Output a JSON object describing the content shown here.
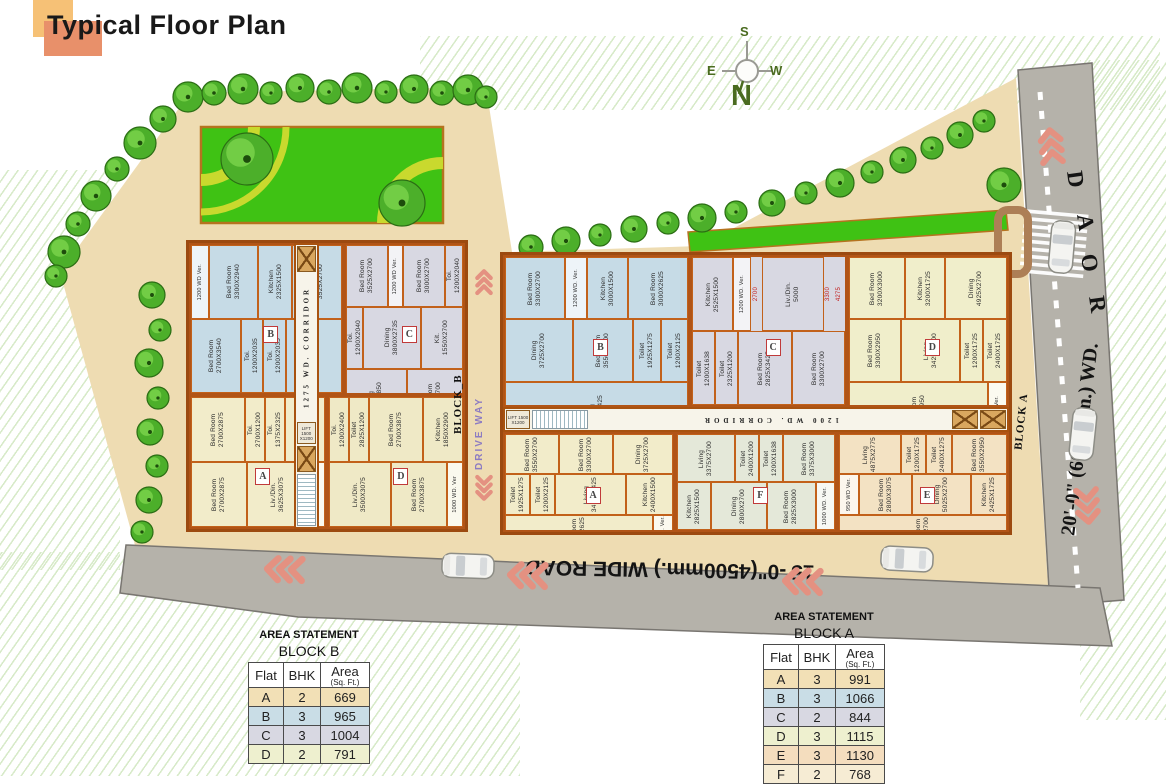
{
  "title": "Typical Floor Plan",
  "compass": {
    "north": "N",
    "south": "S",
    "east": "E",
    "west": "W"
  },
  "site": {
    "driveway_label": "DRIVE WAY",
    "bottom_road_label": "15'-0\"(4500mm.) WIDE ROAD",
    "right_road_width_label": "20'-0\" (6000mm.) WD.",
    "road_letters": [
      "R",
      "O",
      "A",
      "D"
    ]
  },
  "palette": {
    "site_tan": "#eedcb2",
    "road_gray": "#b5b2aa",
    "lawn_green": "#3fc214",
    "wall_orange": "#c2611a",
    "chevron_salmon": "#e49181"
  },
  "blocks": [
    {
      "name": "BLOCK_B",
      "corridor_label": "1275 WD. CORRIDOR",
      "lift_label": "LIFT 1500 X1200",
      "flats": [
        {
          "letter": "B",
          "color": "#c6dbe6",
          "rooms": [
            {
              "kind": "ver",
              "label": "1200 WD Ver.",
              "dim": ""
            },
            {
              "kind": "bed",
              "label": "Bed Room",
              "dim": "3300X2940"
            },
            {
              "kind": "kitchen",
              "label": "Kitchen",
              "dim": "2325X1500"
            },
            {
              "kind": "bed",
              "label": "Bed Room",
              "dim": "3525X2700"
            },
            {
              "kind": "bed",
              "label": "Bed Room",
              "dim": "2700X3540"
            },
            {
              "kind": "toilet",
              "label": "Toi.",
              "dim": "1200X2035"
            },
            {
              "kind": "toilet",
              "label": "Toi.",
              "dim": "1200X2035"
            },
            {
              "kind": "living",
              "label": "Liv./Din.",
              "dim": "2700X5425"
            }
          ]
        },
        {
          "letter": "C",
          "color": "#d8d8e2",
          "rooms": [
            {
              "kind": "bed",
              "label": "Bed Room",
              "dim": "3525X2700"
            },
            {
              "kind": "ver",
              "label": "1200 WD Ver.",
              "dim": ""
            },
            {
              "kind": "bed",
              "label": "Bed Room",
              "dim": "3000X2700"
            },
            {
              "kind": "toilet",
              "label": "Toi.",
              "dim": "1200X2040"
            },
            {
              "kind": "toilet",
              "label": "Toi.",
              "dim": "1200X2040"
            },
            {
              "kind": "dining",
              "label": "Dining",
              "dim": "3800X2735"
            },
            {
              "kind": "kitchen",
              "label": "Kit.",
              "dim": "1550X2700"
            },
            {
              "kind": "living",
              "label": "Living",
              "dim": "2700X4850"
            },
            {
              "kind": "bed",
              "label": "Bed Room",
              "dim": "3000X2700"
            }
          ]
        },
        {
          "letter": "A",
          "color": "#f2ecca",
          "rooms": [
            {
              "kind": "bed",
              "label": "Bed Room",
              "dim": "2700X2875"
            },
            {
              "kind": "toilet",
              "label": "Toi.",
              "dim": "2700X1200"
            },
            {
              "kind": "toilet",
              "label": "Toi.",
              "dim": "1375X2325"
            },
            {
              "kind": "kitchen",
              "label": "Kitchen",
              "dim": "1850X1900"
            },
            {
              "kind": "bed",
              "label": "Bed Room",
              "dim": "2700X2875"
            },
            {
              "kind": "living",
              "label": "Liv./Din.",
              "dim": "3625X3075"
            },
            {
              "kind": "ver",
              "label": "1000 WD. Ver",
              "dim": ""
            }
          ]
        },
        {
          "letter": "D",
          "color": "#efe9c6",
          "rooms": [
            {
              "kind": "toilet",
              "label": "Toi.",
              "dim": "1200X2400"
            },
            {
              "kind": "toilet",
              "label": "Toilet",
              "dim": "2825X1200"
            },
            {
              "kind": "bed",
              "label": "Bed Room",
              "dim": "2700X3875"
            },
            {
              "kind": "kitchen",
              "label": "Kitchen",
              "dim": "1850X2900"
            },
            {
              "kind": "living",
              "label": "Liv./Din.",
              "dim": "3500X3075"
            },
            {
              "kind": "bed",
              "label": "Bed Room",
              "dim": "2700X3875"
            },
            {
              "kind": "ver",
              "label": "1000 WD. Ver",
              "dim": ""
            }
          ]
        }
      ]
    },
    {
      "name": "BLOCK A",
      "corridor_label": "1200 WD. CORRIDOR",
      "lift_label": "LIFT 1500 X1200",
      "flats": [
        {
          "letter": "B",
          "color": "#c6dbe6",
          "rooms": [
            {
              "kind": "bed",
              "label": "Bed Room",
              "dim": "3300X2700"
            },
            {
              "kind": "ver",
              "label": "1200 WD. Ver.",
              "dim": ""
            },
            {
              "kind": "kitchen",
              "label": "Kitchen",
              "dim": "3000X1500"
            },
            {
              "kind": "bed",
              "label": "Bed Room",
              "dim": "3000X2625"
            },
            {
              "kind": "dining",
              "label": "Dining",
              "dim": "3725X2700"
            },
            {
              "kind": "bed",
              "label": "Bed Room",
              "dim": "3550X2700"
            },
            {
              "kind": "toilet",
              "label": "Toilet",
              "dim": "1925X1275"
            },
            {
              "kind": "toilet",
              "label": "Toilet",
              "dim": "1200X2125"
            },
            {
              "kind": "living",
              "label": "Living",
              "dim": "4575X3425"
            }
          ]
        },
        {
          "letter": "C",
          "color": "#d8d8e2",
          "rooms": [
            {
              "kind": "kitchen",
              "label": "Kitchen",
              "dim": "2525X1500"
            },
            {
              "kind": "ver",
              "label": "1200 WD. Ver.",
              "dim": ""
            },
            {
              "kind": "dim",
              "label": "2700",
              "dim": ""
            },
            {
              "kind": "living",
              "label": "Liv./Din.",
              "dim": "5000"
            },
            {
              "kind": "dim",
              "label": "3300",
              "dim": ""
            },
            {
              "kind": "dim",
              "label": "4275",
              "dim": ""
            },
            {
              "kind": "toilet",
              "label": "Toilet",
              "dim": "1200X1638"
            },
            {
              "kind": "toilet",
              "label": "Toilet",
              "dim": "2325X1200"
            },
            {
              "kind": "bed",
              "label": "Bed Room",
              "dim": "2825X3425"
            },
            {
              "kind": "bed",
              "label": "Bed Room",
              "dim": "3300X2700"
            }
          ]
        },
        {
          "letter": "D",
          "color": "#f0eecb",
          "rooms": [
            {
              "kind": "bed",
              "label": "Bed Room",
              "dim": "3200X3000"
            },
            {
              "kind": "kitchen",
              "label": "Kitchen",
              "dim": "3200X1725"
            },
            {
              "kind": "dining",
              "label": "Dining",
              "dim": "4925X2700"
            },
            {
              "kind": "bed",
              "label": "Bed Room",
              "dim": "3300X2950"
            },
            {
              "kind": "living",
              "label": "Living",
              "dim": "3425X4100"
            },
            {
              "kind": "toilet",
              "label": "Toilet",
              "dim": "1200X1725"
            },
            {
              "kind": "toilet",
              "label": "Toilet",
              "dim": "2400X1725"
            },
            {
              "kind": "bed",
              "label": "Bed Room",
              "dim": "3550X2950"
            },
            {
              "kind": "ver",
              "label": "950 WD Ver.",
              "dim": ""
            }
          ]
        },
        {
          "letter": "A",
          "color": "#f2ecca",
          "rooms": [
            {
              "kind": "bed",
              "label": "Bed Room",
              "dim": "3550X2700"
            },
            {
              "kind": "bed",
              "label": "Bed Room",
              "dim": "3300X2700"
            },
            {
              "kind": "dining",
              "label": "Dining",
              "dim": "3725X2700"
            },
            {
              "kind": "toilet",
              "label": "Toilet",
              "dim": "1925X1275"
            },
            {
              "kind": "toilet",
              "label": "Toilet",
              "dim": "1200X2125"
            },
            {
              "kind": "living",
              "label": "Living",
              "dim": "3425X3425"
            },
            {
              "kind": "kitchen",
              "label": "Kitchen",
              "dim": "2400X1500"
            },
            {
              "kind": "bed",
              "label": "Bed Room",
              "dim": "3000X2625"
            },
            {
              "kind": "ver",
              "label": "1200 WD. Ver.",
              "dim": ""
            }
          ]
        },
        {
          "letter": "F",
          "color": "#e4e8d9",
          "rooms": [
            {
              "kind": "living",
              "label": "Living",
              "dim": "3375X2700"
            },
            {
              "kind": "toilet",
              "label": "Toilet",
              "dim": "2400X1200"
            },
            {
              "kind": "toilet",
              "label": "Toilet",
              "dim": "1200X1638"
            },
            {
              "kind": "bed",
              "label": "Bed Room",
              "dim": "3375X3000"
            },
            {
              "kind": "kitchen",
              "label": "Kitchen",
              "dim": "2825X1500"
            },
            {
              "kind": "dining",
              "label": "Dining",
              "dim": "2800X2700"
            },
            {
              "kind": "bed",
              "label": "Bed Room",
              "dim": "2825X3000"
            },
            {
              "kind": "ver",
              "label": "1000 WD. Ver.",
              "dim": ""
            }
          ]
        },
        {
          "letter": "E",
          "color": "#f3e2c3",
          "rooms": [
            {
              "kind": "living",
              "label": "Living",
              "dim": "4875X2775"
            },
            {
              "kind": "toilet",
              "label": "Toilet",
              "dim": "1200X1725"
            },
            {
              "kind": "toilet",
              "label": "Toilet",
              "dim": "2400X1275"
            },
            {
              "kind": "bed",
              "label": "Bed Room",
              "dim": "3550X2950"
            },
            {
              "kind": "ver",
              "label": "950 WD Ver.",
              "dim": ""
            },
            {
              "kind": "bed",
              "label": "Bed Room",
              "dim": "2800X3075"
            },
            {
              "kind": "dining",
              "label": "Dining",
              "dim": "5025X2700"
            },
            {
              "kind": "kitchen",
              "label": "Kitchen",
              "dim": "2425X1725"
            },
            {
              "kind": "bed",
              "label": "Bed Room",
              "dim": "3400X2700"
            }
          ]
        }
      ]
    }
  ],
  "area_tables": [
    {
      "title": "AREA STATEMENT",
      "block": "BLOCK B",
      "headers": {
        "flat": "Flat",
        "bhk": "BHK",
        "area": "Area",
        "area_sub": "(Sq. Ft.)"
      },
      "rows": [
        {
          "flat": "A",
          "bhk": "2",
          "area": "669",
          "color": "#f2e0b6"
        },
        {
          "flat": "B",
          "bhk": "3",
          "area": "965",
          "color": "#c9dde6"
        },
        {
          "flat": "C",
          "bhk": "3",
          "area": "1004",
          "color": "#d8d8e2"
        },
        {
          "flat": "D",
          "bhk": "2",
          "area": "791",
          "color": "#eef0cf"
        }
      ]
    },
    {
      "title": "AREA STATEMENT",
      "block": "BLOCK A",
      "headers": {
        "flat": "Flat",
        "bhk": "BHK",
        "area": "Area",
        "area_sub": "(Sq. Ft.)"
      },
      "rows": [
        {
          "flat": "A",
          "bhk": "3",
          "area": "991",
          "color": "#f2e0b6"
        },
        {
          "flat": "B",
          "bhk": "3",
          "area": "1066",
          "color": "#c9dde6"
        },
        {
          "flat": "C",
          "bhk": "2",
          "area": "844",
          "color": "#d8d8e2"
        },
        {
          "flat": "D",
          "bhk": "3",
          "area": "1115",
          "color": "#eef0cf"
        },
        {
          "flat": "E",
          "bhk": "3",
          "area": "1130",
          "color": "#f4ddbe"
        },
        {
          "flat": "F",
          "bhk": "2",
          "area": "768",
          "color": "#f6ecd4"
        }
      ]
    }
  ]
}
